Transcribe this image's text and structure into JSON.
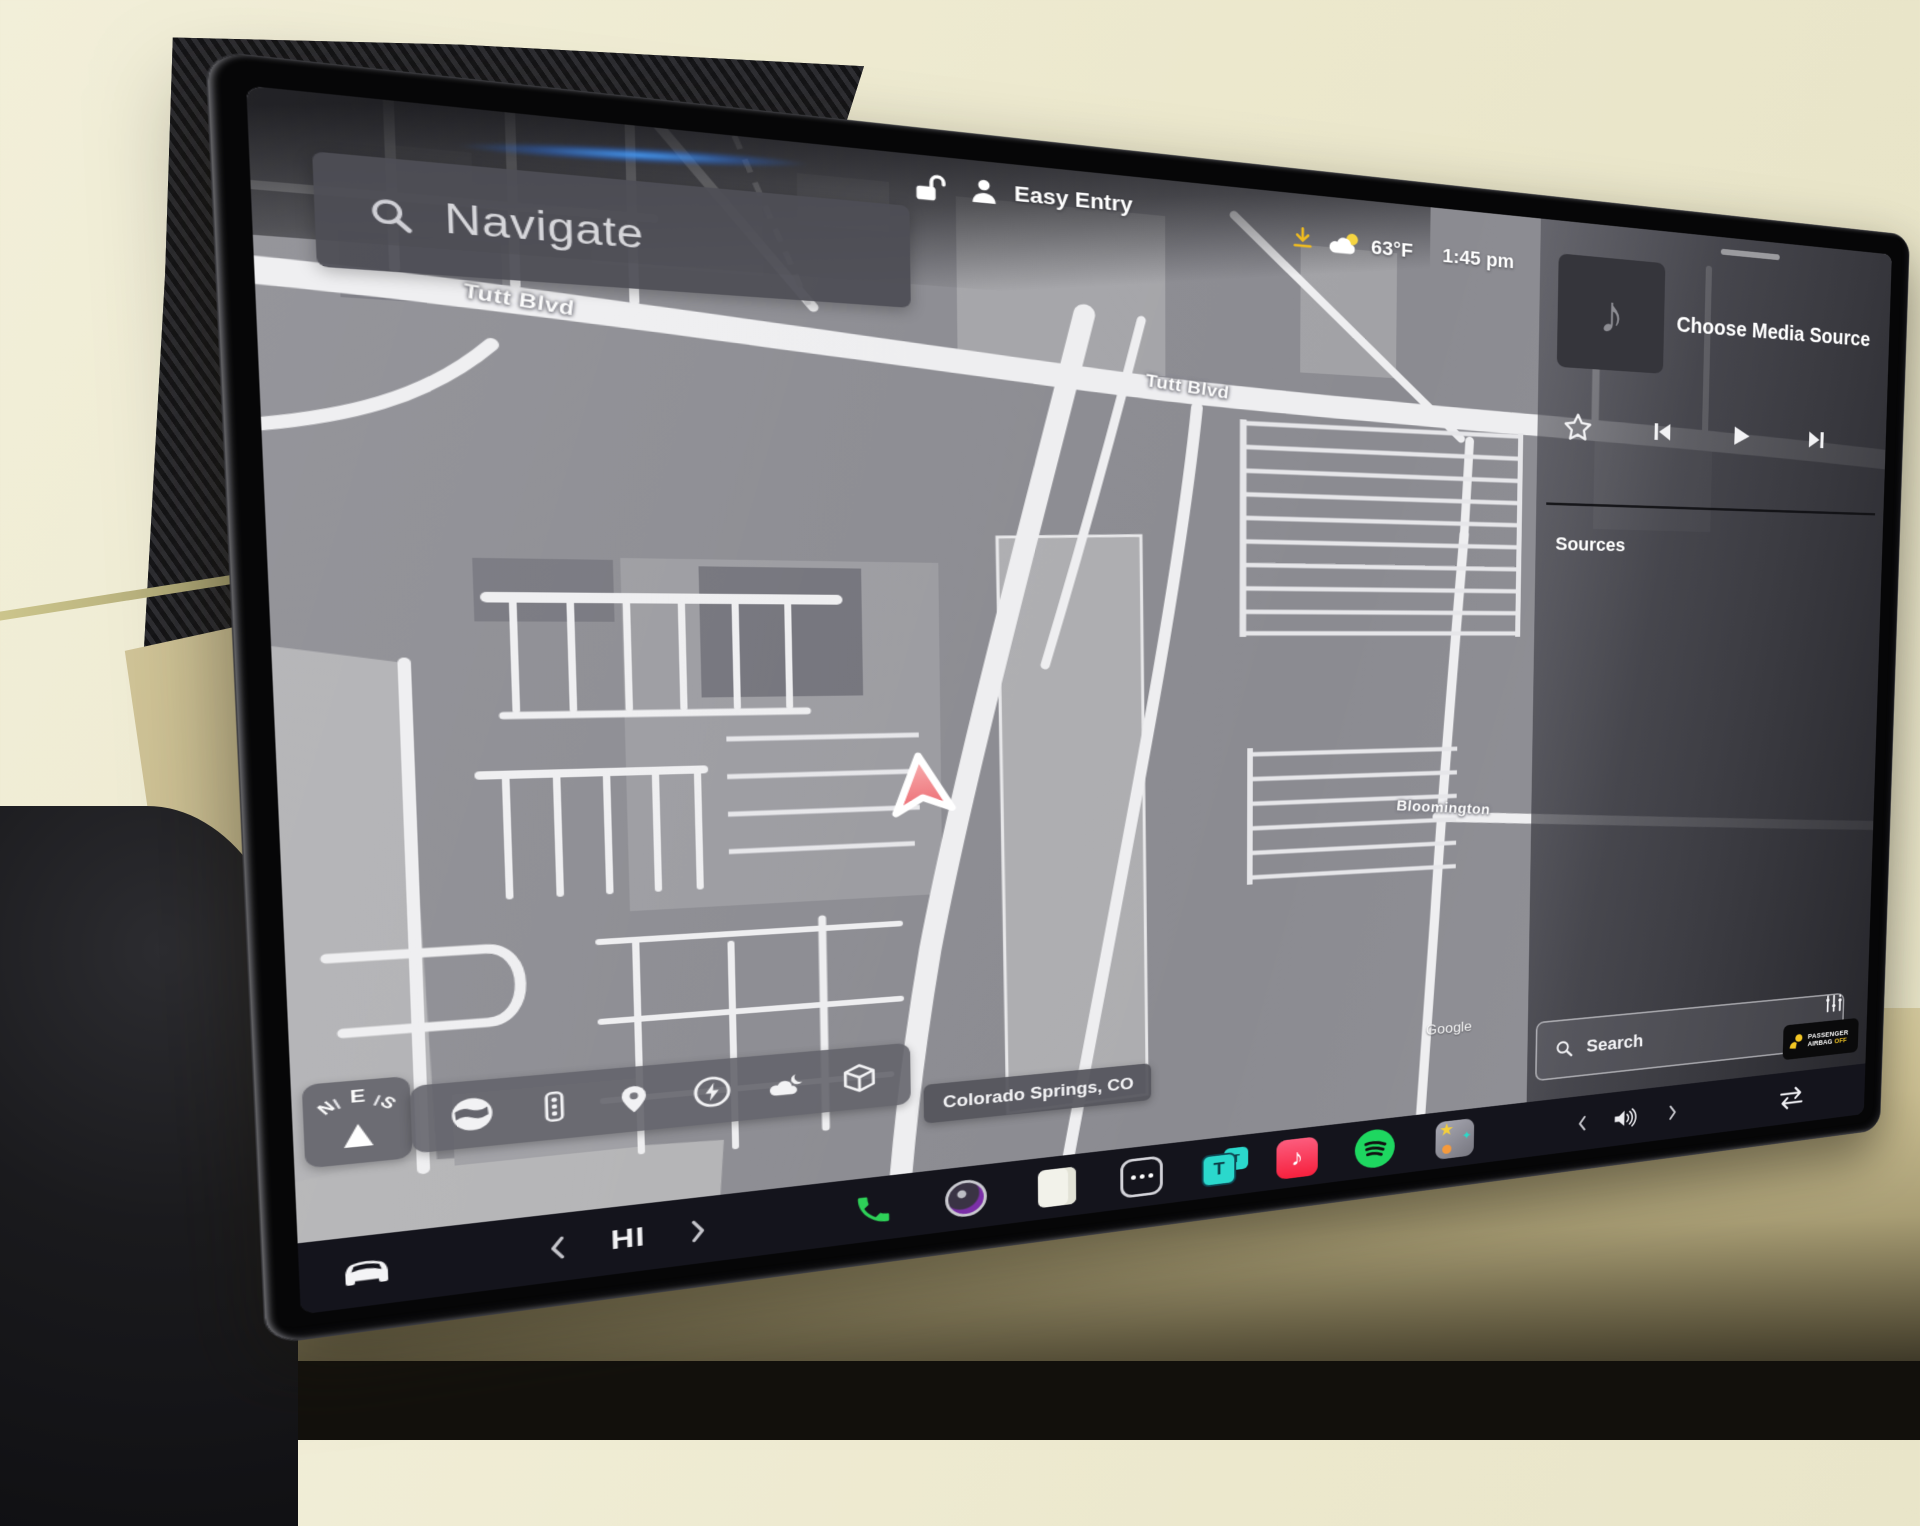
{
  "status_bar": {
    "profile": "Easy Entry",
    "temperature": "63°F",
    "time": "1:45 pm"
  },
  "nav": {
    "search_placeholder": "Navigate",
    "location_chip": "Colorado Springs, CO",
    "watermark": "Google",
    "streets": [
      "Tutt Blvd",
      "Tutt Blvd",
      "Bloomington"
    ],
    "compass_letters": [
      "N",
      "E",
      "S"
    ]
  },
  "media": {
    "title": "Choose Media Source",
    "sources_heading": "Sources",
    "search_placeholder": "Search"
  },
  "airbag_badge": {
    "line1": "PASSENGER",
    "line2": "AIRBAG",
    "status": "OFF"
  },
  "climate": {
    "temperature": "HI"
  },
  "apps": {
    "tesla_glyph": "T",
    "tesla_back_glyph": "T",
    "music_note": "♪",
    "toybox_star": "★",
    "toybox_spark": "✦"
  },
  "dock_app_names": [
    "vehicle-controls",
    "temp-down",
    "temp-up",
    "phone",
    "dashcam",
    "notes",
    "all-apps",
    "tesla-media",
    "apple-music",
    "spotify",
    "toybox",
    "volume-down",
    "volume-up",
    "media-swap"
  ],
  "map_tool_names": [
    "map-style-globe",
    "traffic-signals",
    "map-pins",
    "charging",
    "weather",
    "3d-view"
  ],
  "colors": {
    "nav_arrow_red": "#ee6b72",
    "phone_green": "#2ed158",
    "spotify_green": "#1ed760",
    "tesla_cyan": "#2bd8cc",
    "apple_music_red": "#fa2d48",
    "yellow_accent": "#f3c623",
    "download_yellow": "#f0bc1f",
    "dock_bg": "#14141c",
    "map_bg": "#8b8b91"
  }
}
